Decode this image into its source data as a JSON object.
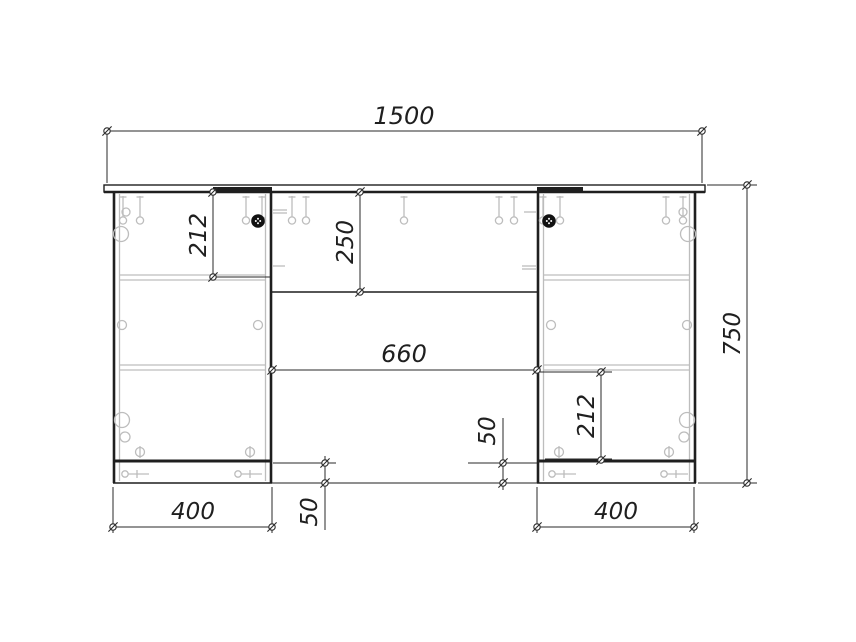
{
  "drawing": {
    "background": "#ffffff",
    "line_color": "#1f1f1f",
    "hardware_color": "#bdbdbd",
    "cam_lock_color": "#111111",
    "dimensions": {
      "width_total": "1500",
      "height_total": "750",
      "pedestal_left_width": "400",
      "pedestal_right_width": "400",
      "kneehole_width": "660",
      "apron_height": "250",
      "left_top_section": "212",
      "right_bottom_section": "212",
      "plinth_left": "50",
      "plinth_right": "50"
    }
  }
}
